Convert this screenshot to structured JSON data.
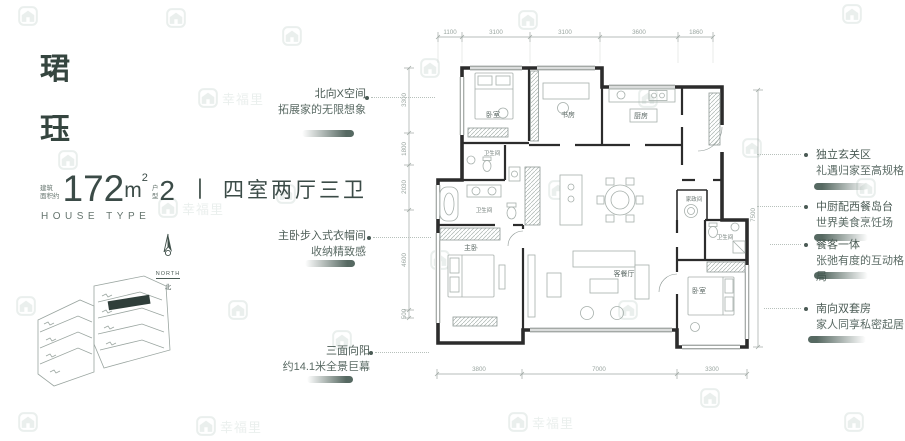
{
  "brand": {
    "watermark_text": "幸福里"
  },
  "header": {
    "title_char_1": "珺",
    "title_char_2": "珏",
    "area_prefix_line1": "建筑",
    "area_prefix_line2": "面积约",
    "area_value": "172",
    "area_unit": "m",
    "area_sup": "2",
    "type_prefix_line1": "户",
    "type_prefix_line2": "型",
    "type_number": "2",
    "separator": "丨",
    "layout_text": "四室两厅三卫",
    "subtitle": "HOUSE TYPE"
  },
  "compass": {
    "label_en": "NORTH",
    "label_cn": "北"
  },
  "annotations": {
    "left": [
      {
        "line1": "北向X空间",
        "line2": "拓展家的无限想象"
      },
      {
        "line1": "主卧步入式衣帽间",
        "line2": "收纳精致感"
      },
      {
        "line1": "三面向阳",
        "line2": "约14.1米全景巨幕"
      }
    ],
    "right": [
      {
        "line1": "独立玄关区",
        "line2": "礼遇归家至高规格"
      },
      {
        "line1": "中厨配西餐岛台",
        "line2": "世界美食烹饪场"
      },
      {
        "line1": "餐客一体",
        "line2": "张弛有度的互动格局"
      },
      {
        "line1": "南向双套房",
        "line2": "家人同享私密起居"
      }
    ]
  },
  "floor_plan": {
    "rooms": {
      "bedroom_top_left": "卧室",
      "study": "书房",
      "kitchen": "厨房",
      "bath_upper": "卫生间",
      "bath_master": "卫生间",
      "utility": "家政间",
      "bath_right": "卫生间",
      "master_bedroom": "主卧",
      "living_dining": "客餐厅",
      "bedroom_bottom_right": "卧室"
    },
    "dimensions": {
      "top": [
        "1100",
        "3100",
        "3100",
        "3600",
        "1860"
      ],
      "bottom": [
        "3800",
        "7000",
        "3300"
      ],
      "left": [
        "3300",
        "1800",
        "2030",
        "4600",
        "500"
      ],
      "right": [
        "7500"
      ]
    }
  },
  "colors": {
    "accent_dark": "#3f544c",
    "text_main": "#3b4b47",
    "watermark": "#8fa9a0"
  }
}
